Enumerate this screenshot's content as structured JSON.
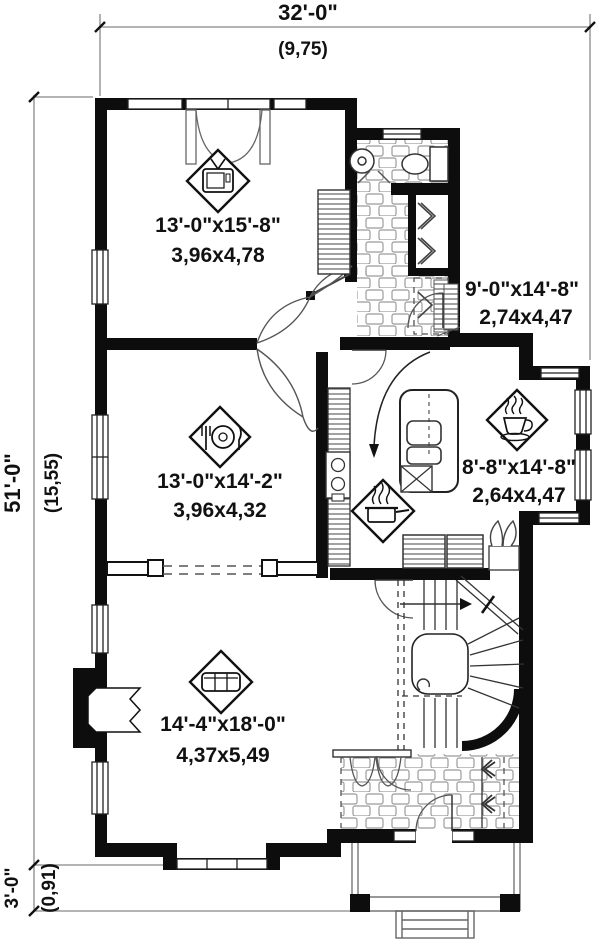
{
  "title": "house first floor plan",
  "dimensions": {
    "overall_width_ft": "32'-0\"",
    "overall_width_m": "(9,75)",
    "overall_depth_ft": "51'-0\"",
    "overall_depth_m": "(15,55)",
    "porch_depth_ft": "3'-0\"",
    "porch_depth_m": "(0,91)"
  },
  "rooms": {
    "family_room": {
      "size_ft": "13'-0\"x15'-8\"",
      "size_m": "3,96x4,78",
      "icon": "tv-icon"
    },
    "dining_room": {
      "size_ft": "13'-0\"x14'-2\"",
      "size_m": "3,96x4,32",
      "icon": "dining-icon"
    },
    "hall_bath": {
      "size_ft": "9'-0\"x14'-8\"",
      "size_m": "2,74x4,47"
    },
    "breakfast_nook": {
      "size_ft": "8'-8\"x14'-8\"",
      "size_m": "2,64x4,47",
      "icon": "coffee-icon"
    },
    "kitchen": {
      "icon": "pot-icon"
    },
    "living_room": {
      "size_ft": "14'-4\"x18'-0\"",
      "size_m": "4,37x5,49",
      "icon": "sofa-icon"
    }
  },
  "colors": {
    "wall": "#0d0d0d",
    "thin_line": "#666666",
    "tile_line": "#9b9b9b",
    "background": "#ffffff",
    "text": "#111111"
  }
}
